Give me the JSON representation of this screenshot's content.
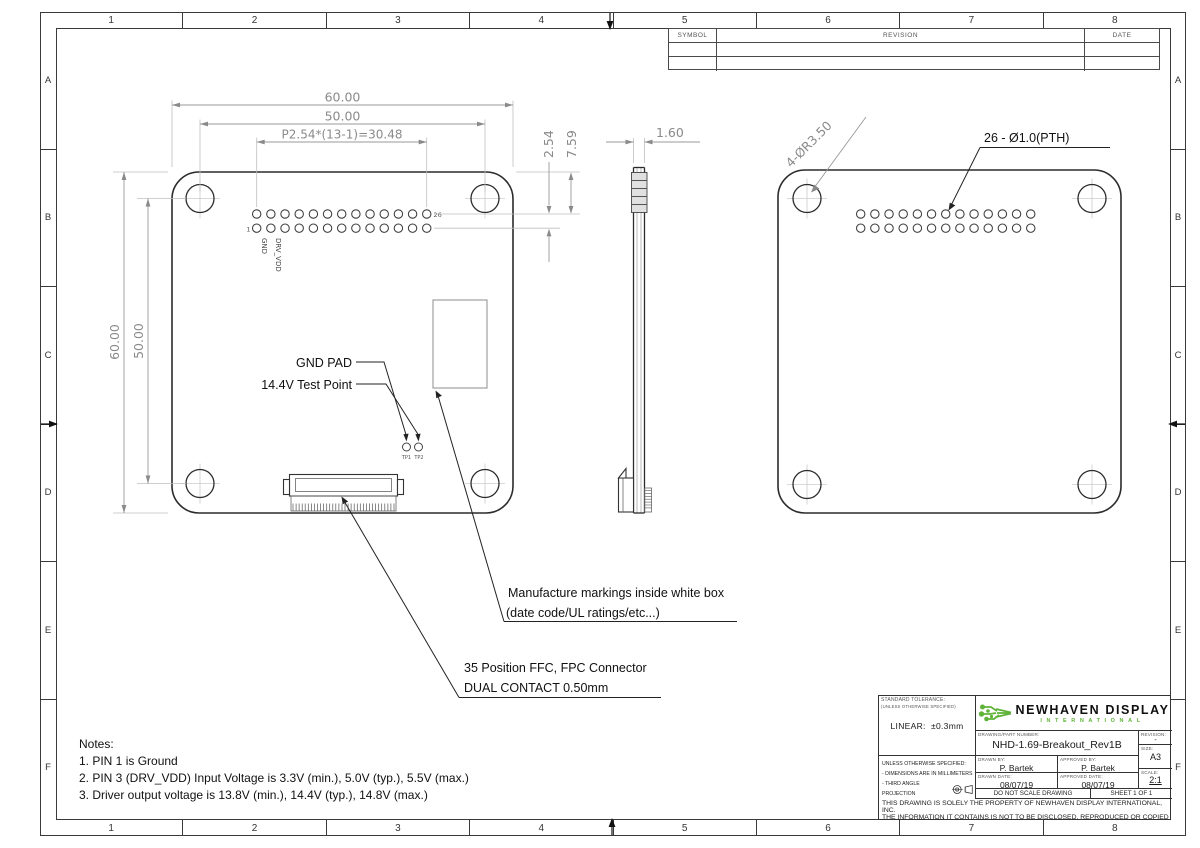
{
  "sheet": {
    "grid_cols": [
      "1",
      "2",
      "3",
      "4",
      "5",
      "6",
      "7",
      "8"
    ],
    "grid_rows": [
      "A",
      "B",
      "C",
      "D",
      "E",
      "F"
    ]
  },
  "revision_table": {
    "symbol": "SYMBOL",
    "revision": "REVISION",
    "date": "DATE"
  },
  "views": {
    "front": {
      "dim_width_outer": "60.00",
      "dim_width_holes": "50.00",
      "dim_pitch": "P2.54*(13-1)=30.48",
      "dim_row_gap": "2.54",
      "dim_row_offset": "7.59",
      "dim_height_outer": "60.00",
      "dim_height_holes": "50.00",
      "pin1": "1",
      "pin26": "26",
      "pin1_name": "GND",
      "pin3_name": "DRV_VDD",
      "tp1": "TP1",
      "tp2": "TP2",
      "callout_gnd_pad": "GND PAD",
      "callout_test_point": "14.4V Test Point",
      "callout_marking_1": "Manufacture markings inside white box",
      "callout_marking_2": "(date code/UL ratings/etc...)",
      "callout_ffc_1": "35 Position FFC, FPC Connector",
      "callout_ffc_2": "DUAL CONTACT 0.50mm"
    },
    "side": {
      "dim_thickness": "1.60"
    },
    "back": {
      "callout_corner": "4-ØR3.50",
      "callout_holes": "26 - Ø1.0(PTH)"
    }
  },
  "notes": {
    "title": "Notes:",
    "items": [
      "1.  PIN 1 is Ground",
      "2.  PIN 3 (DRV_VDD) Input Voltage is 3.3V (min.), 5.0V (typ.), 5.5V (max.)",
      "3.  Driver output voltage is 13.8V (min.), 14.4V (typ.), 14.8V (max.)"
    ]
  },
  "title_block": {
    "tolerance_label": "STANDARD TOLERANCE:",
    "tolerance_sub": "(UNLESS OTHERWISE SPECIFIED)",
    "linear_label": "LINEAR:",
    "linear_value": "±0.3mm",
    "brand": "NEWHAVEN DISPLAY",
    "brand_sub": "INTERNATIONAL",
    "part_label": "DRAWING/PART NUMBER:",
    "part_number": "NHD-1.69-Breakout_Rev1B",
    "revision_label": "REVISION:",
    "revision_value": "-",
    "size_label": "SIZE:",
    "size_value": "A3",
    "unless_label": "UNLESS OTHERWISE SPECIFIED:",
    "spec_mm": "- DIMENSIONS ARE IN MILLIMETERS",
    "spec_projection": "- THIRD ANGLE PROJECTION",
    "drawn_by_label": "DRAWN BY:",
    "drawn_by": "P. Bartek",
    "approved_by_label": "APPROVED BY:",
    "approved_by": "P. Bartek",
    "drawn_date_label": "DRAWN DATE:",
    "drawn_date": "08/07/19",
    "approved_date_label": "APPROVED DATE:",
    "approved_date": "08/07/19",
    "scale_label": "SCALE:",
    "scale_value": "2:1",
    "do_not_scale": "DO NOT SCALE DRAWING",
    "sheet_of": "SHEET 1 OF 1",
    "disclaimer_1": "THIS DRAWING IS SOLELY THE PROPERTY OF NEWHAVEN DISPLAY INTERNATIONAL, INC.",
    "disclaimer_2": "THE INFORMATION IT CONTAINS IS NOT TO BE DISCLOSED, REPRODUCED OR COPIED IN",
    "disclaimer_3": "WHOLE OR PART WITHOUT WRITTEN APPROVAL FROM NEWHAVEN DISPLAY."
  },
  "colors": {
    "brand_green": "#5eb338",
    "line": "#2b2b2b",
    "dim": "#8a8a8a"
  }
}
